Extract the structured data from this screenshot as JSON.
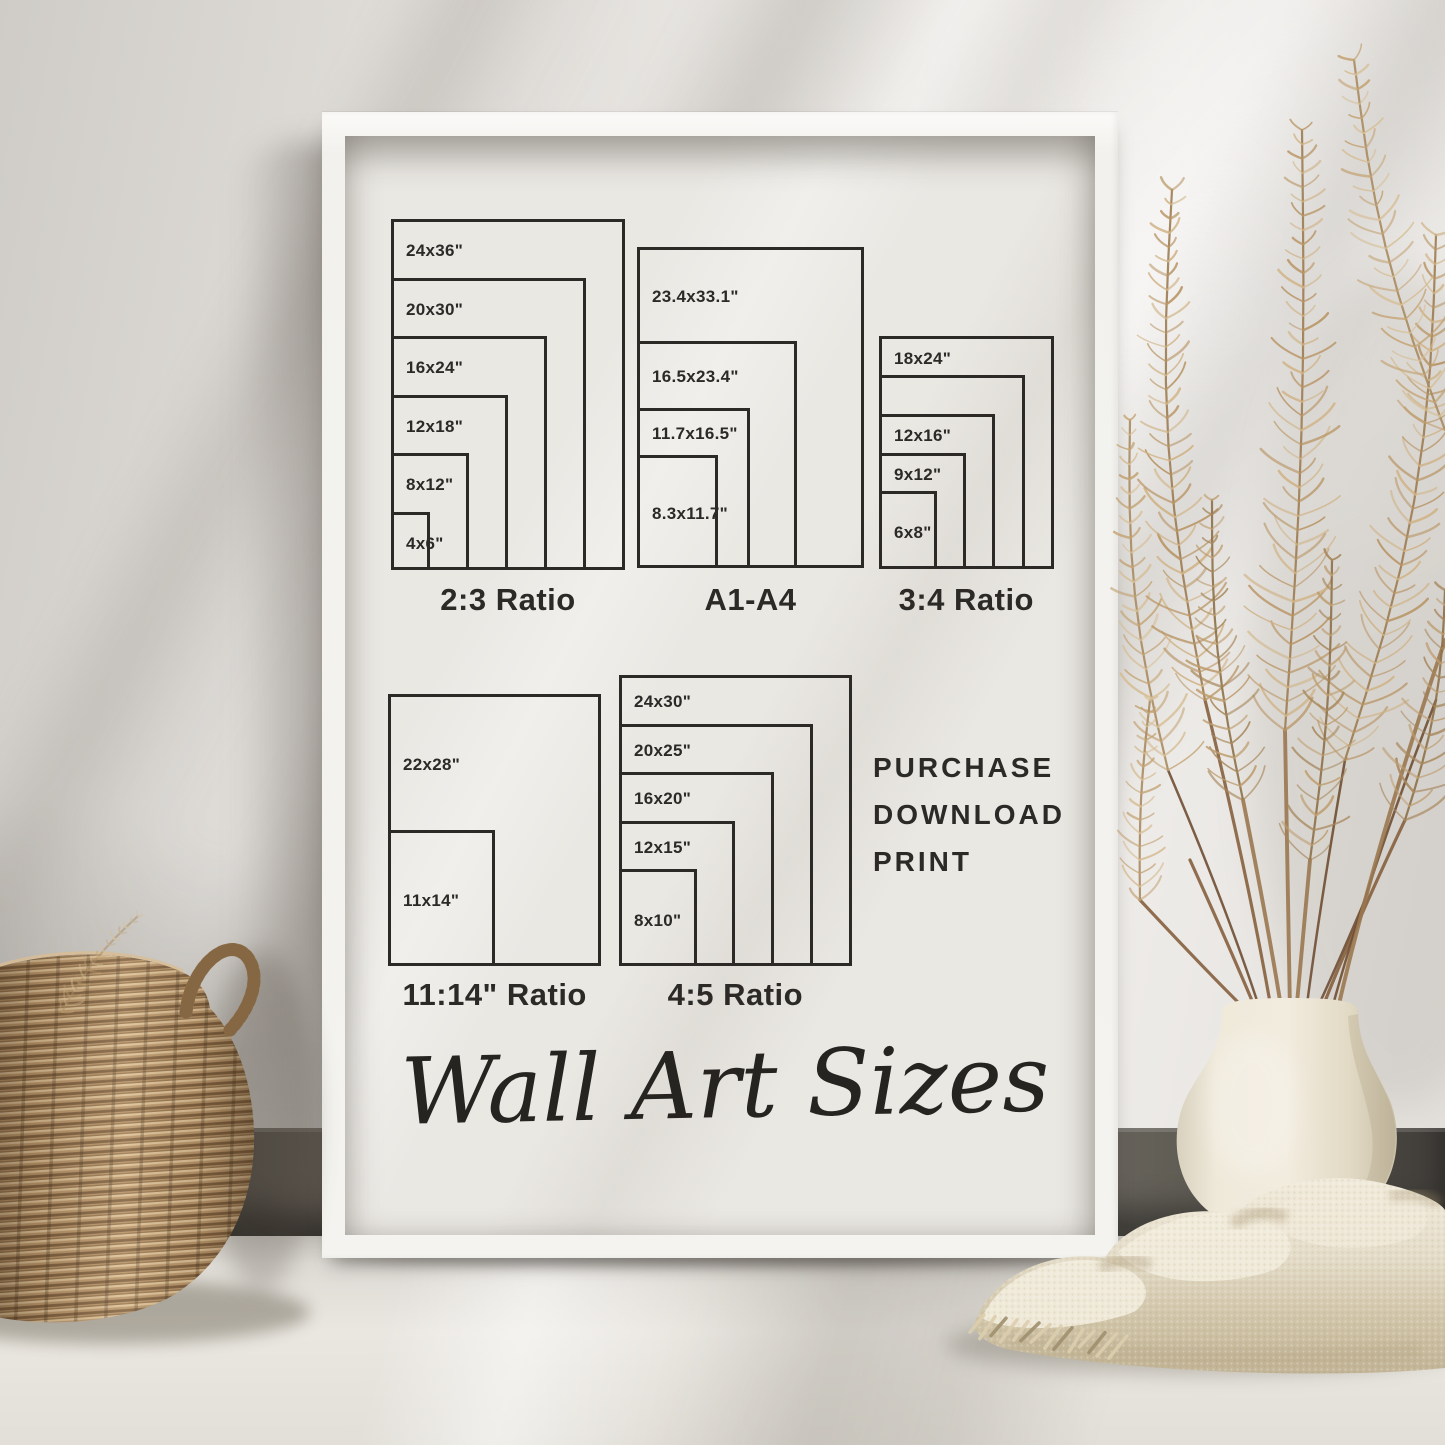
{
  "poster": {
    "script_title": "Wall Art Sizes",
    "colors": {
      "line": "#2b2a27",
      "text": "#2b2a27",
      "poster_bg": "#eae8e3",
      "frame": "#f4f3ef"
    },
    "groups": [
      {
        "caption": "2:3 Ratio",
        "ppi": 9.75,
        "sizes": [
          {
            "label": "24x36\"",
            "w_in": 24,
            "h_in": 36
          },
          {
            "label": "20x30\"",
            "w_in": 20,
            "h_in": 30
          },
          {
            "label": "16x24\"",
            "w_in": 16,
            "h_in": 24
          },
          {
            "label": "12x18\"",
            "w_in": 12,
            "h_in": 18
          },
          {
            "label": "8x12\"",
            "w_in": 8,
            "h_in": 12
          },
          {
            "label": "4x6\"",
            "w_in": 4,
            "h_in": 6
          }
        ]
      },
      {
        "caption": "A1-A4",
        "ppi": 9.7,
        "sizes": [
          {
            "label": "23.4x33.1\"",
            "w_in": 23.4,
            "h_in": 33.1
          },
          {
            "label": "16.5x23.4\"",
            "w_in": 16.5,
            "h_in": 23.4
          },
          {
            "label": "11.7x16.5\"",
            "w_in": 11.7,
            "h_in": 16.5
          },
          {
            "label": "8.3x11.7\"",
            "w_in": 8.3,
            "h_in": 11.7
          }
        ]
      },
      {
        "caption": "3:4 Ratio",
        "ppi": 9.7,
        "sizes": [
          {
            "label": "18x24\"",
            "w_in": 18,
            "h_in": 24
          },
          {
            "label": "",
            "w_in": 15,
            "h_in": 20
          },
          {
            "label": "12x16\"",
            "w_in": 12,
            "h_in": 16
          },
          {
            "label": "9x12\"",
            "w_in": 9,
            "h_in": 12
          },
          {
            "label": "6x8\"",
            "w_in": 6,
            "h_in": 8
          }
        ]
      },
      {
        "caption": "11:14\" Ratio",
        "ppi": 9.7,
        "sizes": [
          {
            "label": "22x28\"",
            "w_in": 22,
            "h_in": 28
          },
          {
            "label": "11x14\"",
            "w_in": 11,
            "h_in": 14
          }
        ]
      },
      {
        "caption": "4:5 Ratio",
        "ppi": 9.7,
        "sizes": [
          {
            "label": "24x30\"",
            "w_in": 24,
            "h_in": 30
          },
          {
            "label": "20x25\"",
            "w_in": 20,
            "h_in": 25
          },
          {
            "label": "16x20\"",
            "w_in": 16,
            "h_in": 20
          },
          {
            "label": "12x15\"",
            "w_in": 12,
            "h_in": 15
          },
          {
            "label": "8x10\"",
            "w_in": 8,
            "h_in": 10
          }
        ]
      }
    ]
  },
  "purchase": {
    "lines": [
      "PURCHASE",
      "DOWNLOAD",
      "PRINT"
    ]
  },
  "scene": {
    "objects": [
      "white-frame",
      "wicker-basket",
      "pampas-grass",
      "ceramic-vase",
      "knit-blanket"
    ]
  }
}
